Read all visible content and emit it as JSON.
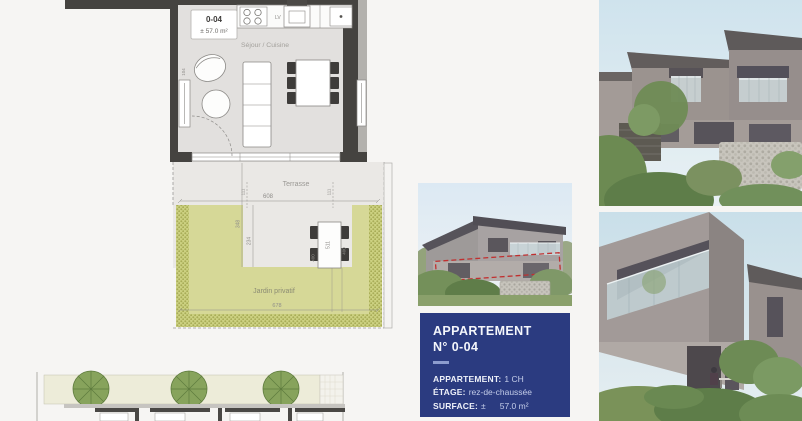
{
  "page": {
    "background": "#f6f5f3"
  },
  "floor_plan": {
    "unit_badge": {
      "number": "0-04",
      "area": "± 57.0 m²"
    },
    "labels": {
      "living_kitchen": "Séjour / Cuisine",
      "terrace": "Terrasse",
      "garden": "Jardin privatif",
      "dishwasher": "LV"
    },
    "dimensions": {
      "terrace_width": "608",
      "terrace_side": "111",
      "terrace_depth": "348",
      "terrace_depth_inner": "234",
      "table_length": "511",
      "table_width": "400",
      "garden_width": "678",
      "radiator": "104"
    },
    "colors": {
      "wall": "#454340",
      "floor": "#e2e0de",
      "terrace": "#eae8e5",
      "garden_green": "#d6d897",
      "dimension_text": "#8f8d8a"
    }
  },
  "info_card": {
    "title_line1": "APPARTEMENT",
    "title_line2": "N° 0-04",
    "details": [
      {
        "label": "APPARTEMENT:",
        "value": "1 CH"
      },
      {
        "label": "ÉTAGE:",
        "value": "rez-de-chaussée"
      },
      {
        "label": "SURFACE:",
        "value": "±",
        "value2": "57.0 m²"
      }
    ],
    "colors": {
      "panel": "#2b3b80",
      "underline": "#8d9cce",
      "highlight_red": "#c03030"
    }
  }
}
